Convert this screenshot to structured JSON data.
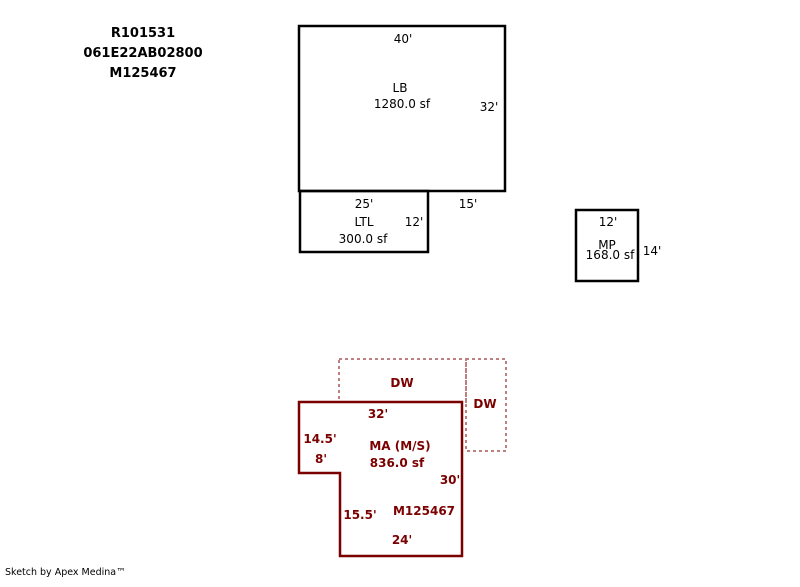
{
  "header": {
    "parcel_id_1": "R101531",
    "parcel_id_2": "061E22AB02800",
    "parcel_id_3": "M125467"
  },
  "colors": {
    "black": "#000000",
    "maroon": "#7b0000",
    "dash_red": "#bd7f7f",
    "background": "#ffffff"
  },
  "areas": {
    "lb": {
      "code": "LB",
      "area": "1280.0 sf",
      "dim_top": "40'",
      "dim_right": "32'",
      "dim_bottom_right": "15'"
    },
    "ltl": {
      "code": "LTL",
      "area": "300.0 sf",
      "dim_top": "25'",
      "dim_right": "12'"
    },
    "mp": {
      "code": "MP",
      "area": "168.0 sf",
      "dim_top": "12'",
      "dim_right": "14'"
    },
    "dw_upper": {
      "code": "DW"
    },
    "dw_right": {
      "code": "DW"
    },
    "ma": {
      "code": "MA (M/S)",
      "area": "836.0 sf",
      "ref_label": "M125467",
      "dim_top": "32'",
      "dim_left_upper": "14.5'",
      "dim_notch": "8'",
      "dim_right": "30'",
      "dim_left_lower": "15.5'",
      "dim_bottom": "24'"
    }
  },
  "footer": {
    "credit": "Sketch by Apex Medina™"
  }
}
